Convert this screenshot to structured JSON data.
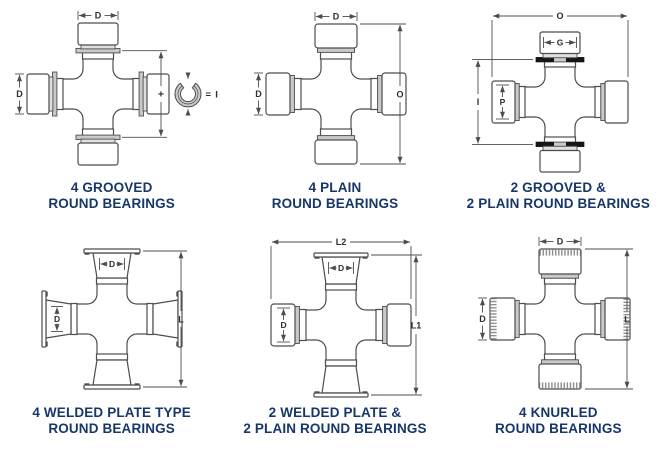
{
  "sheet": {
    "background": "#ffffff"
  },
  "colors": {
    "line": "#4d4d4d",
    "dim_text": "#2e2e2e",
    "caption": "#17376b",
    "gray_band": "#c7c9ca",
    "light_band": "#dfe0e1",
    "black_ring": "#161616",
    "snap_ring_fill": "#c9c9c9",
    "knurl": "#8f8f8f"
  },
  "panels": [
    {
      "id": "4-grooved-round-bearings",
      "caption": [
        "4 GROOVED",
        "ROUND BEARINGS"
      ],
      "labels": {
        "cap_width": "D",
        "cap_diameter": "D",
        "plus": "+",
        "snap_ring_equals": "= I"
      }
    },
    {
      "id": "4-plain-round-bearings",
      "caption": [
        "4 PLAIN",
        "ROUND BEARINGS"
      ],
      "labels": {
        "cap_width": "D",
        "cap_diameter": "D",
        "overall_height": "O"
      }
    },
    {
      "id": "2-grooved-2-plain-round-bearings",
      "caption": [
        "2 GROOVED &",
        "2 PLAIN ROUND BEARINGS"
      ],
      "labels": {
        "overall_width": "O",
        "grooved_cap_width": "G",
        "inside_snap_rings": "I",
        "plain_cap_diameter": "P"
      }
    },
    {
      "id": "4-welded-plate-round-bearings",
      "caption": [
        "4 WELDED PLATE TYPE",
        "ROUND BEARINGS"
      ],
      "labels": {
        "cap_width": "D",
        "cap_diameter": "D",
        "overall_height": "L"
      }
    },
    {
      "id": "2-welded-2-plain-round-bearings",
      "caption": [
        "2 WELDED PLATE &",
        "2 PLAIN ROUND BEARINGS"
      ],
      "labels": {
        "overall_width": "L2",
        "cap_width": "D",
        "cap_diameter": "D",
        "overall_height": "L1"
      }
    },
    {
      "id": "4-knurled-round-bearings",
      "caption": [
        "4 KNURLED",
        "ROUND BEARINGS"
      ],
      "labels": {
        "cap_width": "D",
        "cap_diameter": "D",
        "overall_height": "L"
      }
    }
  ]
}
